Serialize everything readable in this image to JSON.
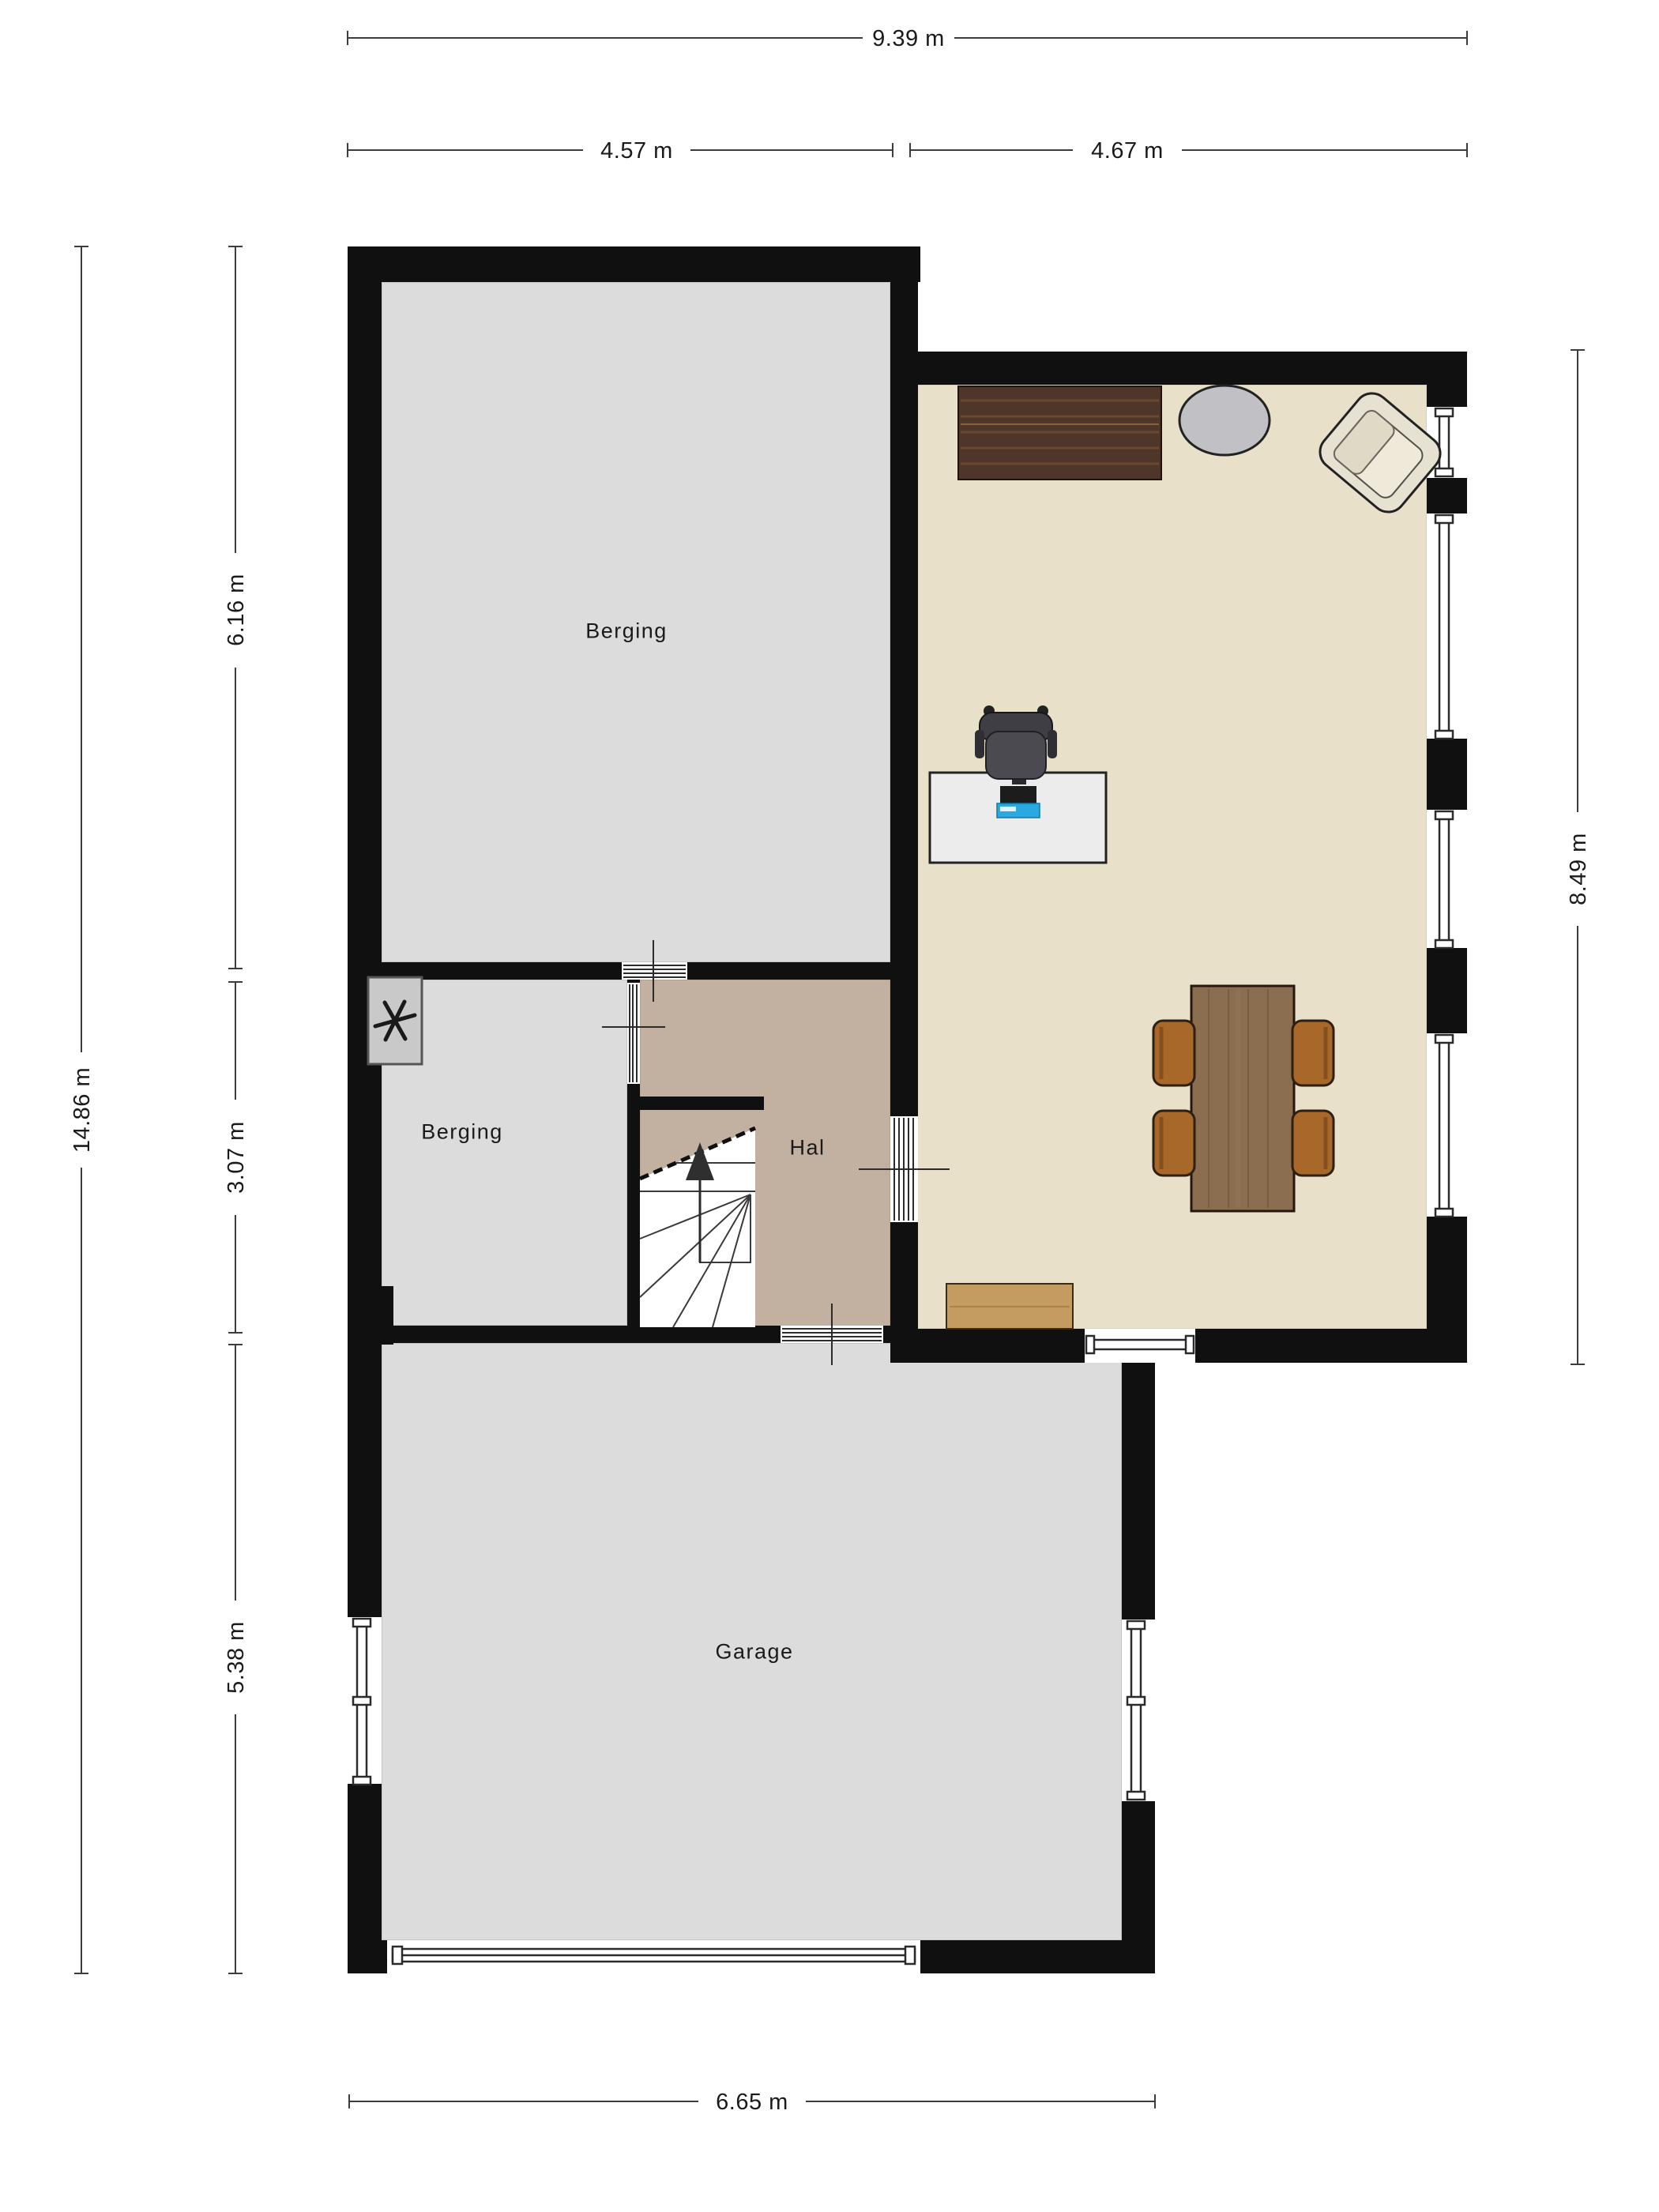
{
  "plan": {
    "rooms": {
      "berging_large": {
        "label": "Berging"
      },
      "berging_small": {
        "label": "Berging"
      },
      "hal": {
        "label": "Hal"
      },
      "garage": {
        "label": "Garage"
      }
    },
    "dimensions": {
      "top_total": "9.39 m",
      "top_left": "4.57 m",
      "top_right": "4.67 m",
      "left_total": "14.86 m",
      "left_top": "6.16 m",
      "left_middle": "3.07 m",
      "left_bottom": "5.38 m",
      "right_side": "8.49 m",
      "bottom": "6.65 m"
    },
    "icons": {
      "ventilation": "fan-asterisk",
      "stairs_direction": "up-arrow"
    },
    "colors": {
      "wall": "#101010",
      "floor_gray": "#dcdcdc",
      "floor_hal": "#c2b1a0",
      "floor_living": "#e8e0c9",
      "opening": "#ffffff",
      "frame": "#2b2b2b",
      "dim_line": "#3c3c3c",
      "text": "#1a1a1a",
      "fan_unit": "#c9c9c9",
      "sideboard": "#4e362b",
      "sideboard_grain": "#7a5230",
      "dining_table": "#8b6d4f",
      "dining_table_grain": "#6e5138",
      "dining_chair": "#a8682a",
      "bench": "#c49b61",
      "round_table": "#c1c1c5",
      "armchair": "#e7e1d1",
      "desk": "#ececec",
      "office_chair": "#3e3e44",
      "laptop_accent": "#2aa9e0"
    }
  }
}
